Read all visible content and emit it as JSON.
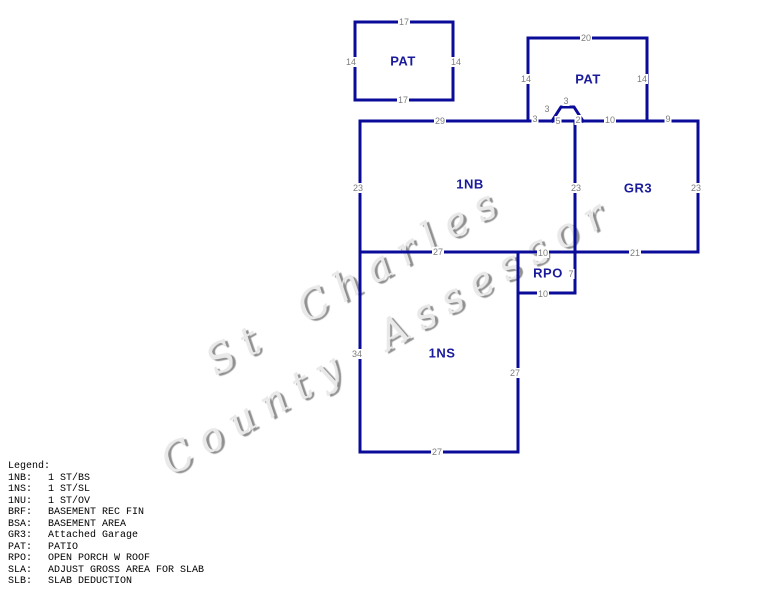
{
  "watermark": {
    "line1": "St Charles",
    "line2": "County Assessor"
  },
  "colors": {
    "line": "#0b0b99",
    "area_label": "#1a1a9c",
    "dimension_label": "#7d7d7d",
    "legend_text": "#000000",
    "watermark_gray": "#8f8f8f",
    "background": "#ffffff"
  },
  "sketch": {
    "area_labels": [
      {
        "name": "patio-1",
        "text": "PAT"
      },
      {
        "name": "patio-2",
        "text": "PAT"
      },
      {
        "name": "one-story-basement",
        "text": "1NB"
      },
      {
        "name": "attached-garage",
        "text": "GR3"
      },
      {
        "name": "open-porch",
        "text": "RPO"
      },
      {
        "name": "one-story-slab",
        "text": "1NS"
      }
    ],
    "dimensions": [
      {
        "name": "pat1-top",
        "text": "17"
      },
      {
        "name": "pat1-left",
        "text": "14"
      },
      {
        "name": "pat1-right",
        "text": "14"
      },
      {
        "name": "pat1-bottom",
        "text": "17"
      },
      {
        "name": "pat2-top",
        "text": "20"
      },
      {
        "name": "pat2-left",
        "text": "14"
      },
      {
        "name": "pat2-right",
        "text": "14"
      },
      {
        "name": "nb-top",
        "text": "29"
      },
      {
        "name": "pat2-bottom-seg1",
        "text": "3"
      },
      {
        "name": "bump-left-diagonal",
        "text": "3"
      },
      {
        "name": "bump-top",
        "text": "3"
      },
      {
        "name": "bump-base",
        "text": "5"
      },
      {
        "name": "bump-right-diagonal",
        "text": "2"
      },
      {
        "name": "pat2-bottom-seg2",
        "text": "10"
      },
      {
        "name": "gr3-top",
        "text": "9"
      },
      {
        "name": "nb-left",
        "text": "23"
      },
      {
        "name": "nb-gr3-divider",
        "text": "23"
      },
      {
        "name": "gr3-right",
        "text": "23"
      },
      {
        "name": "nb-bottom",
        "text": "27"
      },
      {
        "name": "gr3-bottom",
        "text": "21"
      },
      {
        "name": "rpo-top",
        "text": "10"
      },
      {
        "name": "rpo-right",
        "text": "7"
      },
      {
        "name": "rpo-bottom",
        "text": "10"
      },
      {
        "name": "ns-left",
        "text": "34"
      },
      {
        "name": "ns-right",
        "text": "27"
      },
      {
        "name": "ns-bottom",
        "text": "27"
      }
    ]
  },
  "legend": {
    "title": "Legend:",
    "entries": [
      {
        "code": "1NB:",
        "desc": "1 ST/BS"
      },
      {
        "code": "1NS:",
        "desc": "1 ST/SL"
      },
      {
        "code": "1NU:",
        "desc": "1 ST/OV"
      },
      {
        "code": "BRF:",
        "desc": "BASEMENT REC FIN"
      },
      {
        "code": "BSA:",
        "desc": "BASEMENT AREA"
      },
      {
        "code": "GR3:",
        "desc": "Attached Garage"
      },
      {
        "code": "PAT:",
        "desc": "PATIO"
      },
      {
        "code": "RPO:",
        "desc": "OPEN PORCH W ROOF"
      },
      {
        "code": "SLA:",
        "desc": "ADJUST GROSS AREA FOR SLAB"
      },
      {
        "code": "SLB:",
        "desc": "SLAB DEDUCTION"
      }
    ]
  }
}
